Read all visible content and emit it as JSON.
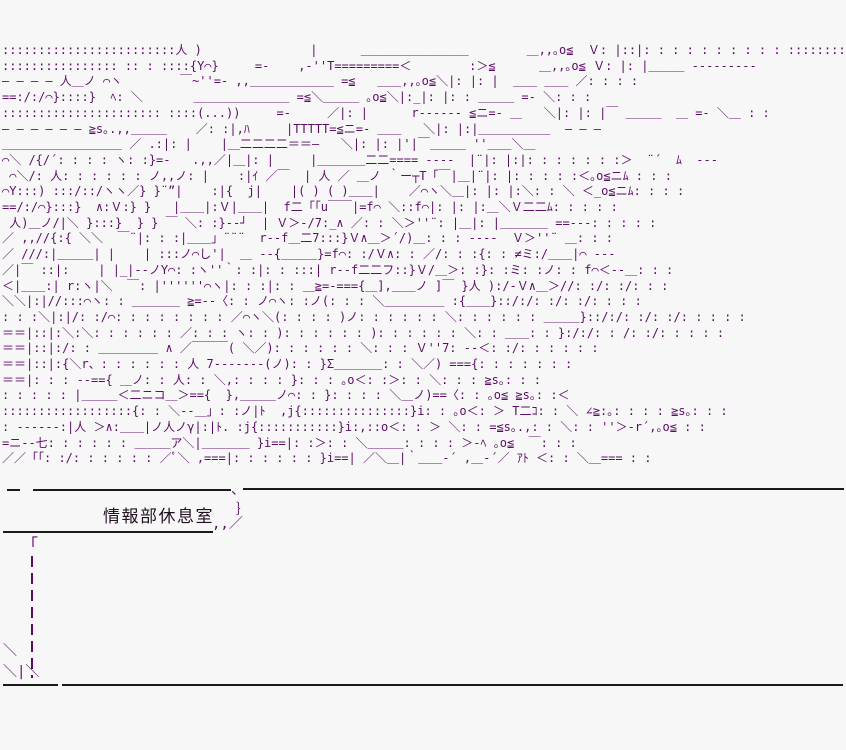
{
  "scene": {
    "label": "情報部休息室",
    "colors": {
      "aa": "#5c0d66",
      "rule": "#1a1a1a",
      "bg": "#f7f7f8",
      "label_text": "#201020"
    },
    "bubble": {
      "tail_top": "、",
      "tail_mid": "｝",
      "tail_bottom": ",,／",
      "corner_bracket": "「"
    },
    "bottom_left_marks": [
      "＼",
      "＼|＼"
    ],
    "aa_lines": [
      "::::::::::::::::::::::::人 )               |      ＿＿＿＿＿＿＿＿＿        ＿,,｡o≦  Ｖ: |::|: : : : : : : : : : ::::::::",
      ":::::::::::::::: :: : ::::{Y⌒}     =-    ,-''T=========＜        :＞≦      ＿,,｡o≦ Ｖ: |: |＿＿＿ ---------",
      "― ― ― ― 人＿ノ ⌒ヽ        ￣~''=- ,,＿＿＿＿＿＿＿ =≦   ＿＿,,｡o≦＼|: |: |  ＿＿ ＿＿ ／: : : :",
      "==:/:/⌒}::::}  ﾍ: ＼       ＿＿＿＿＿＿＿＿ =≦＼＿＿＿ ｡o≦＼|:_|: |: : ＿＿＿ =- ＼: : :",
      ":::::::::::::::::::::: ::::(...))     =-     ／|: |      r------ ≦ニ=- ＿   ＼|: |: |￣ ＿＿＿  ＿ =- ＼＿ : :",
      "― ― ― ― ― ― ≧s｡.,,＿＿＿    ／: :|,ﾊ     |TTTTT=≦ニ=- ＿＿   ＼|: |:|＿＿＿＿＿＿  ― ― ―",
      "＿＿＿＿＿＿＿＿＿＿ ／ .:|: |    |＿二二二二＝＝―   ＼|: |: |'|￣＿＿＿ ''＿＿＼＿",
      "⌒＼ /{/´: : : : ヽ: :}=-   .,,／|＿|: |     |＿＿＿＿二二==== ----  |¨|: |:|: : : : : : :＞  ¨´  ﾑ  ---",
      " ⌒＼/: 人: : : : : : ノ,,ノ: |    :|ｲ ／￣  | 人 ／ ＿ノ ｀ー┬T「￣|＿|¨|: |: : : : :＜｡o≦ニﾑ : : :",
      "⌒Y:::) :::/::/ヽヽ／} }¨”|    :|{  j|    |( ) ( )＿＿|    ／⌒ヽ＼＿|: |: |:＼: : ＼ ＜_o≦ニﾑ: : : :",
      "==/:/⌒}:::}  ∧:Ｖ:} }   |＿＿|:Ｖ|＿＿|  f二「「u￣￣|=f⌒ ＼::f⌒|: |: |:＿＼Ｖ二二ﾑ: : : : :",
      " 人)＿ノ/|＼ }:::}  } } ￣ ＼: :}--┘  | Ｖ＞-/7:_∧ ／: : ＼＞''¨: |＿|: |＿＿＿＿ ==---: : : : :",
      "／ ,,//{:{ ＼＼  ￣¨|: : :|＿＿」¨¨¨  r--f＿二7:::}Ｖ∧＿＞´/)＿: : : ----  Ｖ＞''¨ ＿: : :",
      "／ ///:|＿＿＿| |    | :::ノ⌒し'|  ＿ --{＿＿＿}=f⌒: :/Ｖ∧: : ／/: : :{: : ≠ミ:/＿＿|⌒ ---",
      "／|￣ ::|:    | |_|--ノY⌒: :ヽ''｀: :|: : :::| r--f二二フ::}Ｖ/＿＞: :}: :ミ: :ノ: : f⌒＜--＿: : :",
      "＜|＿＿:| r:ヽ|＼  ￣: |''''''⌒ヽ|: : :|: : ＿≧=-==={＿],＿＿ノ ]￣ }人 ):/-Ｖ∧＿＞//: :/: :/: : :",
      "＼＼|:|//:::⌒ヽ: : ＿＿＿＿ ≧=--〈: : ノ⌒ヽ: :ノ(: : : ＼＿＿＿＿＿ :{＿＿}::/:/: :/: :/: : : :",
      ": : :＼|:|/: :/⌒: : : : : : : : ／⌒ヽ＼(: : : : )ノ: : : : : : ＼: : : : : : ＿＿＿}::/:/: :/: :/: : : : :",
      "＝＝|::|:＼:＼: : : : : : ／: : : ヽ: : ): : : : : : ): : : : : : ＼: : ＿＿: : }:/:/: : /: :/: : : : :",
      "＝＝|::|:/: : ＿＿＿＿＿ ∧ ／￣￣￣( ＼／): : : : : : ＼: : : Ｖ''7: --＜: :/: : : : : :",
      "＝＝|::|:{＼r、: : : : : : 人 7-------(ノ): : }Σ＿＿＿＿: : ＼／) ==={: : : : : : :",
      "＝＝|: : : --=={ ＿ノ: : 人: : ＼,: : : : }: : : ｡o＜: :＞: : ＼: : : ≧s｡: : :",
      ": : : : : |＿＿＿＜二ニコ＿＞=={  },＿＿＿ノ⌒: : }: : : : ＼＿ノ)==〈: : ｡o≦ ≧s｡: :＜",
      "::::::::::::::::::{: : ＼--＿」: :ノ|ﾄ  ,j{:::::::::::::::}i: : ｡o＜: ＞ T二ｺ: : ＼ ∠≧:｡: : : : ≧s｡: : :",
      ": ------:|人 ＞∧:＿＿|ノ人ノγ|:|ﾄ. :j{:::::::::::}i:,::o＜: : ＞ ＼: : =≦s｡.,: : ＼: : ''＞-r´,｡o≦ : :",
      "=ニ--七: : : : : : ＿＿＿ア＼|＿＿＿＿ }i==|: :＞: : ＼＿＿＿: : : : ＞-ﾍ ｡o≦  ￣: : :",
      "／／「「: :/: : : : : : ／ﾟ＼ ,===|: : : : : : }i==| ／＼＿|｀＿＿-´ ,＿-´／ ｱﾄ ＜: : ＼＿=== : :"
    ]
  }
}
